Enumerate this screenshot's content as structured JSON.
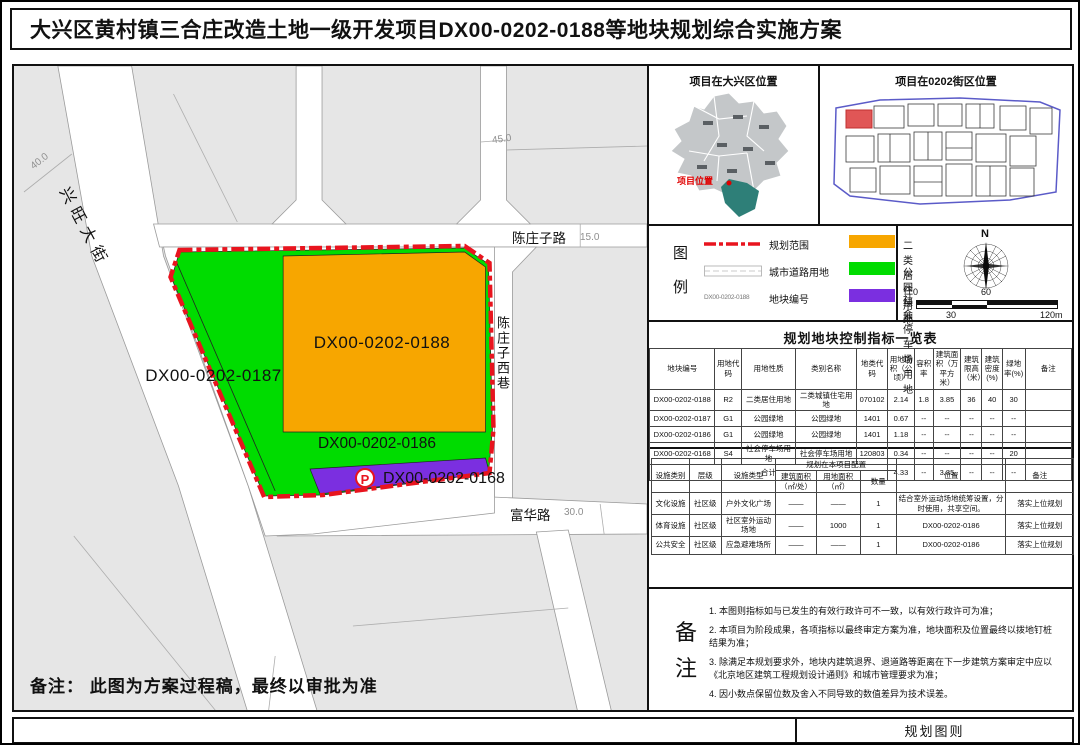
{
  "title": "大兴区黄村镇三合庄改造土地一级开发项目DX00-0202-0188等地块规划综合实施方案",
  "colors": {
    "residential": "#F7A600",
    "park": "#00DC00",
    "parking": "#7B2FE0",
    "boundary": "#E8141E",
    "daxing_highlight": "#2E7F78",
    "block_highlight": "#E05656"
  },
  "map": {
    "note": "备注： 此图为方案过程稿，最终以审批为准",
    "parking_badge": "P",
    "plots": {
      "p0188": "DX00-0202-0188",
      "p0187": "DX00-0202-0187",
      "p0186": "DX00-0202-0186",
      "p0168": "DX00-0202-0168"
    },
    "roads": {
      "xingwang_street": "兴旺大街",
      "chenzhuangzi_road": "陈庄子路",
      "chenzhuangzi_west_lane": "陈庄子西巷",
      "fuhua_road": "富华路"
    },
    "road_widths": {
      "xingwang": "40.0",
      "north_vertical": "45.0",
      "chenzhuangzi": "15.0",
      "fuhua": "30.0"
    }
  },
  "location_maps": {
    "daxing": {
      "title": "项目在大兴区位置",
      "marker_label": "项目位置"
    },
    "block": {
      "title": "项目在0202街区位置"
    }
  },
  "legend": {
    "heading_chars": [
      "图",
      "例"
    ],
    "line_items": [
      {
        "label": "规划范围"
      },
      {
        "label": "城市道路用地"
      },
      {
        "label": "地块编号",
        "sample": "DX00-0202-0188"
      }
    ],
    "fill_items": [
      {
        "label": "二类居住用地"
      },
      {
        "label": "公园绿地"
      },
      {
        "label": "社会停车场用地"
      }
    ]
  },
  "compass": {
    "north": "N",
    "scale_labels_top": [
      "0",
      "60"
    ],
    "scale_labels_bottom": [
      "30",
      "120m"
    ]
  },
  "indicator_table": {
    "title": "规划地块控制指标一览表",
    "headers": [
      "地块编号",
      "用地代码",
      "用地性质",
      "类别名称",
      "地类代码",
      "用地面积（公顷）",
      "容积率",
      "建筑面积（万平方米）",
      "建筑限高（米）",
      "建筑密度(%)",
      "绿地率(%)",
      "备注"
    ],
    "rows": [
      [
        "DX00-0202-0188",
        "R2",
        "二类居住用地",
        "二类城镇住宅用地",
        "070102",
        "2.14",
        "1.8",
        "3.85",
        "36",
        "40",
        "30",
        ""
      ],
      [
        "DX00-0202-0187",
        "G1",
        "公园绿地",
        "公园绿地",
        "1401",
        "0.67",
        "--",
        "--",
        "--",
        "--",
        "--",
        ""
      ],
      [
        "DX00-0202-0186",
        "G1",
        "公园绿地",
        "公园绿地",
        "1401",
        "1.18",
        "--",
        "--",
        "--",
        "--",
        "--",
        ""
      ],
      [
        "DX00-0202-0168",
        "S4",
        "社会停车场用地",
        "社会停车场用地",
        "120803",
        "0.34",
        "--",
        "--",
        "--",
        "--",
        "20",
        ""
      ],
      [
        {
          "t": "合计",
          "cs": 5
        },
        "4.33",
        "--",
        "3.85",
        "--",
        "--",
        "--",
        ""
      ]
    ]
  },
  "facility_table": {
    "col_headers": [
      "设施类别",
      "层级",
      "设施类型"
    ],
    "group_header": "规划在本项目配置",
    "sub_headers": [
      "建筑面积（㎡/处）",
      "用地面积（㎡）",
      "数量"
    ],
    "tail_headers": [
      "位置",
      "备注"
    ],
    "rows": [
      [
        "文化设施",
        "社区级",
        "户外文化广场",
        "——",
        "——",
        "1",
        "结合室外运动场地统筹设置，分时使用，共享空间。",
        "落实上位规划"
      ],
      [
        "体育设施",
        "社区级",
        "社区室外运动场地",
        "——",
        "1000",
        "1",
        "DX00-0202-0186",
        "落实上位规划"
      ],
      [
        "公共安全",
        "社区级",
        "应急避难场所",
        "——",
        "——",
        "1",
        "DX00-0202-0186",
        "落实上位规划"
      ]
    ]
  },
  "notes": {
    "label_chars": [
      "备",
      "注"
    ],
    "items": [
      "1. 本图则指标如与已发生的有效行政许可不一致，以有效行政许可为准；",
      "2. 本项目为阶段成果，各项指标以最终审定方案为准，地块面积及位置最终以拨地钉桩结果为准；",
      "3. 除满足本规划要求外，地块内建筑退界、退道路等距离在下一步建筑方案审定中应以《北京地区建筑工程规划设计通则》和城市管理要求为准；",
      "4. 因小数点保留位数及舍入不同导致的数值差异为技术误差。"
    ]
  },
  "footer": {
    "label": "规划图则"
  }
}
